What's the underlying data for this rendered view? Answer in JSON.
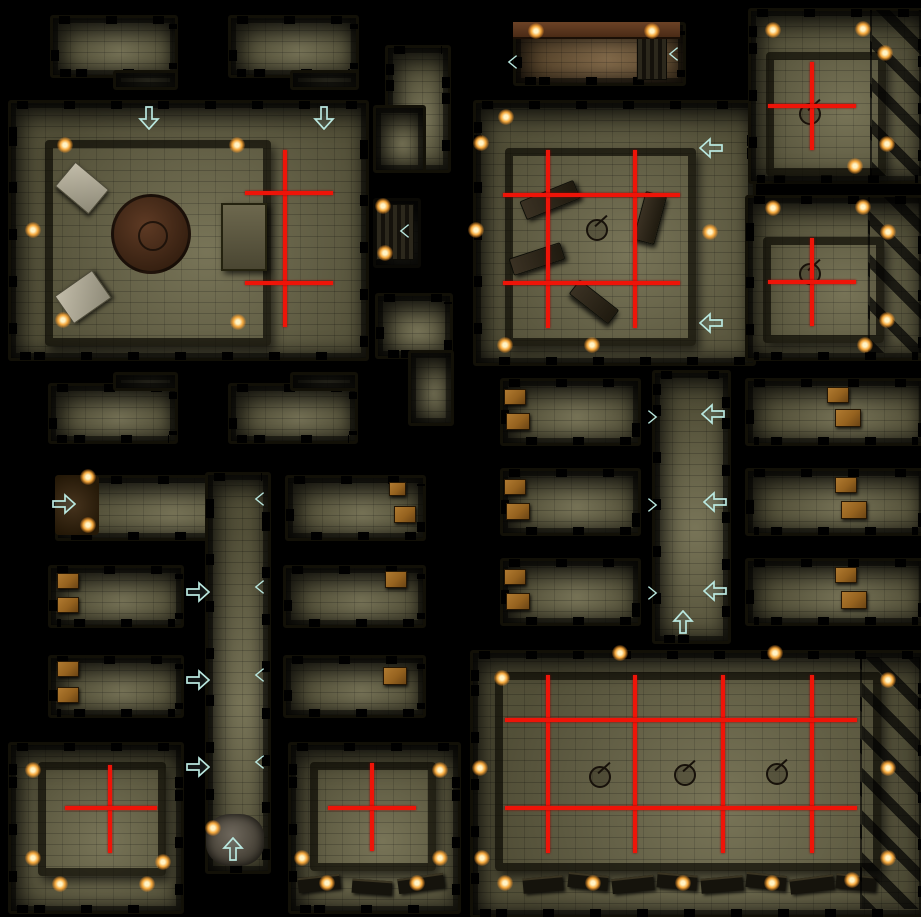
{
  "palette": {
    "floor": "#6e6a4b",
    "floor_brown": "#7a5f3c",
    "wall": "#15130a",
    "red": "#ee1408",
    "arrow": "#b9e7df",
    "torch_core": "#fff3c4",
    "torch_glow": "#f5a93e",
    "crate": "#95621f",
    "tablet": "#c2bca9",
    "rubble": "#6e675c",
    "background": "#000000"
  },
  "map": {
    "width": 921,
    "height": 917,
    "rooms": [
      {
        "id": "nw-small-1",
        "style": "stone",
        "parts": [
          [
            50,
            15,
            122,
            57
          ],
          [
            113,
            70,
            59,
            14
          ]
        ]
      },
      {
        "id": "nw-small-2",
        "style": "stone",
        "parts": [
          [
            228,
            15,
            125,
            57
          ],
          [
            290,
            70,
            63,
            14
          ]
        ]
      },
      {
        "id": "grand-hall-west",
        "style": "stone",
        "parts": [
          [
            8,
            100,
            355,
            255
          ]
        ]
      },
      {
        "id": "north-l-room",
        "style": "stone",
        "parts": [
          [
            385,
            45,
            60,
            122
          ],
          [
            373,
            105,
            47,
            62
          ]
        ]
      },
      {
        "id": "stair-cell",
        "style": "dark",
        "parts": [
          [
            373,
            198,
            42,
            64
          ]
        ]
      },
      {
        "id": "mid-l-room",
        "style": "stone",
        "parts": [
          [
            375,
            293,
            72,
            60
          ],
          [
            408,
            350,
            40,
            70
          ]
        ]
      },
      {
        "id": "north-entry-hall",
        "style": "brown",
        "parts": [
          [
            513,
            22,
            167,
            58
          ]
        ]
      },
      {
        "id": "crypt-hall-center",
        "style": "stone",
        "parts": [
          [
            473,
            100,
            277,
            260
          ]
        ]
      },
      {
        "id": "ne-room-1",
        "style": "stone",
        "parts": [
          [
            748,
            8,
            173,
            170
          ]
        ]
      },
      {
        "id": "ne-room-2",
        "style": "stone",
        "parts": [
          [
            745,
            195,
            176,
            160
          ]
        ]
      },
      {
        "id": "w-row1-left",
        "style": "stone",
        "parts": [
          [
            48,
            383,
            124,
            55
          ],
          [
            113,
            372,
            59,
            13
          ]
        ]
      },
      {
        "id": "w-row1-mid",
        "style": "stone",
        "parts": [
          [
            228,
            383,
            124,
            55
          ],
          [
            290,
            372,
            62,
            13
          ]
        ]
      },
      {
        "id": "w-row2-long",
        "style": "stone",
        "parts": [
          [
            55,
            475,
            210,
            60
          ]
        ]
      },
      {
        "id": "w-row2-right",
        "style": "stone",
        "parts": [
          [
            285,
            475,
            135,
            60
          ]
        ]
      },
      {
        "id": "center-corridor",
        "style": "stone",
        "parts": [
          [
            205,
            472,
            60,
            396
          ]
        ]
      },
      {
        "id": "w-row3-left",
        "style": "stone",
        "parts": [
          [
            48,
            565,
            130,
            57
          ]
        ]
      },
      {
        "id": "w-row3-right",
        "style": "stone",
        "parts": [
          [
            283,
            565,
            137,
            57
          ]
        ]
      },
      {
        "id": "w-row4-left",
        "style": "stone",
        "parts": [
          [
            48,
            655,
            130,
            57
          ]
        ]
      },
      {
        "id": "w-row4-right",
        "style": "stone",
        "parts": [
          [
            283,
            655,
            137,
            57
          ]
        ]
      },
      {
        "id": "e-row1-left",
        "style": "stone",
        "parts": [
          [
            500,
            378,
            135,
            62
          ]
        ]
      },
      {
        "id": "e-row1-right",
        "style": "stone",
        "parts": [
          [
            745,
            378,
            176,
            62
          ]
        ]
      },
      {
        "id": "e-corridor",
        "style": "stone",
        "parts": [
          [
            652,
            370,
            73,
            268
          ]
        ]
      },
      {
        "id": "e-row2-left",
        "style": "stone",
        "parts": [
          [
            500,
            468,
            135,
            62
          ]
        ]
      },
      {
        "id": "e-row2-right",
        "style": "stone",
        "parts": [
          [
            745,
            468,
            176,
            62
          ]
        ]
      },
      {
        "id": "e-row3-left",
        "style": "stone",
        "parts": [
          [
            500,
            558,
            135,
            62
          ]
        ]
      },
      {
        "id": "e-row3-right",
        "style": "stone",
        "parts": [
          [
            745,
            558,
            176,
            62
          ]
        ]
      },
      {
        "id": "sw-shrine",
        "style": "stone",
        "parts": [
          [
            8,
            742,
            170,
            166
          ]
        ]
      },
      {
        "id": "s-shrine",
        "style": "stone",
        "parts": [
          [
            288,
            742,
            167,
            166
          ]
        ]
      },
      {
        "id": "se-great-hall",
        "style": "stone",
        "parts": [
          [
            470,
            650,
            451,
            262
          ]
        ]
      }
    ],
    "red_lines": [
      [
        283,
        150,
        4,
        177
      ],
      [
        245,
        191,
        88,
        4
      ],
      [
        245,
        281,
        88,
        4
      ],
      [
        546,
        150,
        4,
        178
      ],
      [
        633,
        150,
        4,
        178
      ],
      [
        503,
        193,
        177,
        4
      ],
      [
        503,
        281,
        177,
        4
      ],
      [
        810,
        62,
        4,
        88
      ],
      [
        768,
        104,
        88,
        4
      ],
      [
        810,
        238,
        4,
        88
      ],
      [
        768,
        280,
        88,
        4
      ],
      [
        108,
        765,
        4,
        88
      ],
      [
        65,
        806,
        92,
        4
      ],
      [
        370,
        763,
        4,
        88
      ],
      [
        328,
        806,
        88,
        4
      ],
      [
        546,
        675,
        4,
        178
      ],
      [
        633,
        675,
        4,
        178
      ],
      [
        721,
        675,
        4,
        178
      ],
      [
        810,
        675,
        4,
        178
      ],
      [
        505,
        718,
        352,
        4
      ],
      [
        505,
        806,
        352,
        4
      ]
    ],
    "arrows": [
      {
        "x": 150,
        "y": 115,
        "dir": "down"
      },
      {
        "x": 325,
        "y": 115,
        "dir": "down"
      },
      {
        "x": 710,
        "y": 147,
        "dir": "left"
      },
      {
        "x": 710,
        "y": 322,
        "dir": "left"
      },
      {
        "x": 712,
        "y": 413,
        "dir": "left"
      },
      {
        "x": 714,
        "y": 501,
        "dir": "left"
      },
      {
        "x": 714,
        "y": 590,
        "dir": "left"
      },
      {
        "x": 63,
        "y": 499,
        "dir": "right"
      },
      {
        "x": 197,
        "y": 587,
        "dir": "right"
      },
      {
        "x": 197,
        "y": 675,
        "dir": "right"
      },
      {
        "x": 197,
        "y": 762,
        "dir": "right"
      },
      {
        "x": 230,
        "y": 846,
        "dir": "up"
      },
      {
        "x": 680,
        "y": 619,
        "dir": "up"
      }
    ],
    "chevrons": [
      {
        "x": 406,
        "y": 231,
        "dir": "left"
      },
      {
        "x": 514,
        "y": 62,
        "dir": "left"
      },
      {
        "x": 675,
        "y": 54,
        "dir": "left"
      },
      {
        "x": 261,
        "y": 499,
        "dir": "left"
      },
      {
        "x": 261,
        "y": 587,
        "dir": "left"
      },
      {
        "x": 261,
        "y": 675,
        "dir": "left"
      },
      {
        "x": 261,
        "y": 762,
        "dir": "left"
      },
      {
        "x": 650,
        "y": 413,
        "dir": "right"
      },
      {
        "x": 650,
        "y": 501,
        "dir": "right"
      },
      {
        "x": 650,
        "y": 589,
        "dir": "right"
      }
    ],
    "torches": [
      [
        65,
        145
      ],
      [
        237,
        145
      ],
      [
        33,
        230
      ],
      [
        63,
        320
      ],
      [
        238,
        322
      ],
      [
        383,
        206
      ],
      [
        385,
        253
      ],
      [
        536,
        31
      ],
      [
        652,
        31
      ],
      [
        506,
        117
      ],
      [
        481,
        143
      ],
      [
        476,
        230
      ],
      [
        710,
        232
      ],
      [
        505,
        345
      ],
      [
        592,
        345
      ],
      [
        773,
        30
      ],
      [
        863,
        29
      ],
      [
        885,
        53
      ],
      [
        887,
        144
      ],
      [
        855,
        166
      ],
      [
        773,
        208
      ],
      [
        863,
        207
      ],
      [
        888,
        232
      ],
      [
        887,
        320
      ],
      [
        865,
        345
      ],
      [
        88,
        477
      ],
      [
        88,
        525
      ],
      [
        213,
        828
      ],
      [
        33,
        770
      ],
      [
        33,
        858
      ],
      [
        60,
        884
      ],
      [
        147,
        884
      ],
      [
        163,
        862
      ],
      [
        440,
        770
      ],
      [
        302,
        858
      ],
      [
        327,
        883
      ],
      [
        417,
        883
      ],
      [
        440,
        858
      ],
      [
        620,
        653
      ],
      [
        775,
        653
      ],
      [
        502,
        678
      ],
      [
        480,
        768
      ],
      [
        482,
        858
      ],
      [
        888,
        680
      ],
      [
        888,
        768
      ],
      [
        888,
        858
      ],
      [
        505,
        883
      ],
      [
        593,
        883
      ],
      [
        683,
        883
      ],
      [
        772,
        883
      ],
      [
        852,
        880
      ]
    ],
    "objects": [
      {
        "type": "inner",
        "x": 45,
        "y": 140,
        "w": 210,
        "h": 190
      },
      {
        "type": "inner",
        "x": 505,
        "y": 148,
        "w": 175,
        "h": 182
      },
      {
        "type": "inner",
        "x": 766,
        "y": 52,
        "w": 104,
        "h": 108
      },
      {
        "type": "inner",
        "x": 763,
        "y": 237,
        "w": 105,
        "h": 90
      },
      {
        "type": "inner",
        "x": 38,
        "y": 762,
        "w": 112,
        "h": 98
      },
      {
        "type": "inner",
        "x": 310,
        "y": 762,
        "w": 110,
        "h": 93
      },
      {
        "type": "inner",
        "x": 495,
        "y": 672,
        "w": 370,
        "h": 183
      },
      {
        "type": "dais",
        "x": 111,
        "y": 194,
        "w": 74,
        "h": 74
      },
      {
        "type": "tablet",
        "x": 60,
        "y": 172,
        "w": 42,
        "h": 30,
        "rot": 40
      },
      {
        "type": "tablet",
        "x": 60,
        "y": 280,
        "w": 44,
        "h": 32,
        "rot": -35
      },
      {
        "type": "table",
        "x": 221,
        "y": 203,
        "w": 42,
        "h": 64,
        "rot": 0
      },
      {
        "type": "coffin",
        "x": 521,
        "y": 190,
        "w": 56,
        "h": 18,
        "rot": -22
      },
      {
        "type": "coffin",
        "x": 639,
        "y": 193,
        "w": 20,
        "h": 48,
        "rot": 15
      },
      {
        "type": "coffin",
        "x": 510,
        "y": 250,
        "w": 52,
        "h": 16,
        "rot": -18
      },
      {
        "type": "coffin",
        "x": 569,
        "y": 293,
        "w": 48,
        "h": 16,
        "rot": 38
      },
      {
        "type": "candelabra",
        "x": 586,
        "y": 219
      },
      {
        "type": "candelabra",
        "x": 799,
        "y": 103
      },
      {
        "type": "candelabra",
        "x": 799,
        "y": 263
      },
      {
        "type": "candelabra",
        "x": 589,
        "y": 766
      },
      {
        "type": "candelabra",
        "x": 674,
        "y": 764
      },
      {
        "type": "candelabra",
        "x": 766,
        "y": 763
      },
      {
        "type": "crate",
        "x": 389,
        "y": 482,
        "w": 15,
        "h": 12
      },
      {
        "type": "crate",
        "x": 394,
        "y": 506,
        "w": 20,
        "h": 15
      },
      {
        "type": "crate",
        "x": 57,
        "y": 573,
        "w": 20,
        "h": 14
      },
      {
        "type": "crate",
        "x": 57,
        "y": 597,
        "w": 20,
        "h": 14
      },
      {
        "type": "crate",
        "x": 385,
        "y": 571,
        "w": 20,
        "h": 15
      },
      {
        "type": "crate",
        "x": 57,
        "y": 661,
        "w": 20,
        "h": 14
      },
      {
        "type": "crate",
        "x": 57,
        "y": 687,
        "w": 20,
        "h": 14
      },
      {
        "type": "crate",
        "x": 383,
        "y": 667,
        "w": 22,
        "h": 16
      },
      {
        "type": "crate",
        "x": 504,
        "y": 389,
        "w": 20,
        "h": 14
      },
      {
        "type": "crate",
        "x": 506,
        "y": 413,
        "w": 22,
        "h": 15
      },
      {
        "type": "crate",
        "x": 827,
        "y": 387,
        "w": 20,
        "h": 14
      },
      {
        "type": "crate",
        "x": 835,
        "y": 409,
        "w": 24,
        "h": 16
      },
      {
        "type": "crate",
        "x": 504,
        "y": 479,
        "w": 20,
        "h": 14
      },
      {
        "type": "crate",
        "x": 506,
        "y": 503,
        "w": 22,
        "h": 15
      },
      {
        "type": "crate",
        "x": 835,
        "y": 477,
        "w": 20,
        "h": 14
      },
      {
        "type": "crate",
        "x": 841,
        "y": 501,
        "w": 24,
        "h": 16
      },
      {
        "type": "crate",
        "x": 504,
        "y": 569,
        "w": 20,
        "h": 14
      },
      {
        "type": "crate",
        "x": 506,
        "y": 593,
        "w": 22,
        "h": 15
      },
      {
        "type": "crate",
        "x": 835,
        "y": 567,
        "w": 20,
        "h": 14
      },
      {
        "type": "crate",
        "x": 841,
        "y": 591,
        "w": 24,
        "h": 16
      },
      {
        "type": "stairs",
        "x": 376,
        "y": 204,
        "w": 36,
        "h": 54
      },
      {
        "type": "stairs",
        "x": 637,
        "y": 33,
        "w": 28,
        "h": 45
      },
      {
        "type": "brownband",
        "x": 513,
        "y": 22,
        "w": 167,
        "h": 15
      },
      {
        "type": "rubble",
        "x": 206,
        "y": 814,
        "w": 58,
        "h": 52
      },
      {
        "type": "cave",
        "x": 55,
        "y": 475,
        "w": 44,
        "h": 60
      },
      {
        "type": "bench",
        "x": 298,
        "y": 876,
        "w": 42,
        "h": 13,
        "rot": -6
      },
      {
        "type": "bench",
        "x": 352,
        "y": 880,
        "w": 40,
        "h": 12,
        "rot": 4
      },
      {
        "type": "bench",
        "x": 398,
        "y": 876,
        "w": 46,
        "h": 13,
        "rot": -8
      },
      {
        "type": "bench",
        "x": 523,
        "y": 877,
        "w": 40,
        "h": 13,
        "rot": -5
      },
      {
        "type": "bench",
        "x": 568,
        "y": 874,
        "w": 40,
        "h": 13,
        "rot": 6
      },
      {
        "type": "bench",
        "x": 612,
        "y": 877,
        "w": 42,
        "h": 13,
        "rot": -6
      },
      {
        "type": "bench",
        "x": 657,
        "y": 874,
        "w": 40,
        "h": 13,
        "rot": 5
      },
      {
        "type": "bench",
        "x": 701,
        "y": 877,
        "w": 42,
        "h": 13,
        "rot": -5
      },
      {
        "type": "bench",
        "x": 746,
        "y": 874,
        "w": 40,
        "h": 13,
        "rot": 6
      },
      {
        "type": "bench",
        "x": 790,
        "y": 877,
        "w": 44,
        "h": 13,
        "rot": -7
      },
      {
        "type": "bench",
        "x": 836,
        "y": 875,
        "w": 40,
        "h": 13,
        "rot": 5
      },
      {
        "type": "buttress",
        "x": 870,
        "y": 10,
        "w": 50,
        "h": 166
      },
      {
        "type": "buttress",
        "x": 868,
        "y": 197,
        "w": 52,
        "h": 156
      },
      {
        "type": "buttress",
        "x": 860,
        "y": 657,
        "w": 58,
        "h": 252
      }
    ]
  }
}
